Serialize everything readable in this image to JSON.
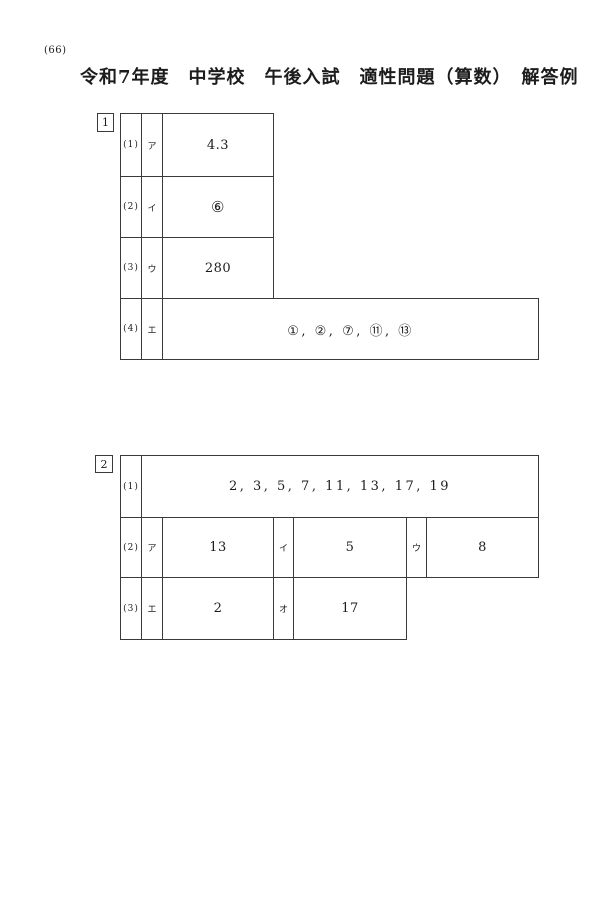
{
  "page": {
    "number": "(66)",
    "title": "令和7年度　中学校　午後入試　適性問題（算数）　解答例"
  },
  "t1": {
    "box_label": "1",
    "rows": [
      {
        "no": "(1)",
        "kana": "ア",
        "answer": "4.3"
      },
      {
        "no": "(2)",
        "kana": "イ",
        "answer": "⑥"
      },
      {
        "no": "(3)",
        "kana": "ウ",
        "answer": "280"
      },
      {
        "no": "(4)",
        "kana": "エ",
        "answer": "①, ②, ⑦, ⑪, ⑬"
      }
    ]
  },
  "t2": {
    "box_label": "2",
    "row1": {
      "no": "(1)",
      "answer": "2, 3, 5, 7, 11, 13, 17, 19"
    },
    "row2": {
      "no": "(2)",
      "cells": [
        {
          "kana": "ア",
          "answer": "13"
        },
        {
          "kana": "イ",
          "answer": "5"
        },
        {
          "kana": "ウ",
          "answer": "8"
        }
      ]
    },
    "row3": {
      "no": "(3)",
      "cells": [
        {
          "kana": "エ",
          "answer": "2"
        },
        {
          "kana": "オ",
          "answer": "17"
        }
      ]
    }
  }
}
